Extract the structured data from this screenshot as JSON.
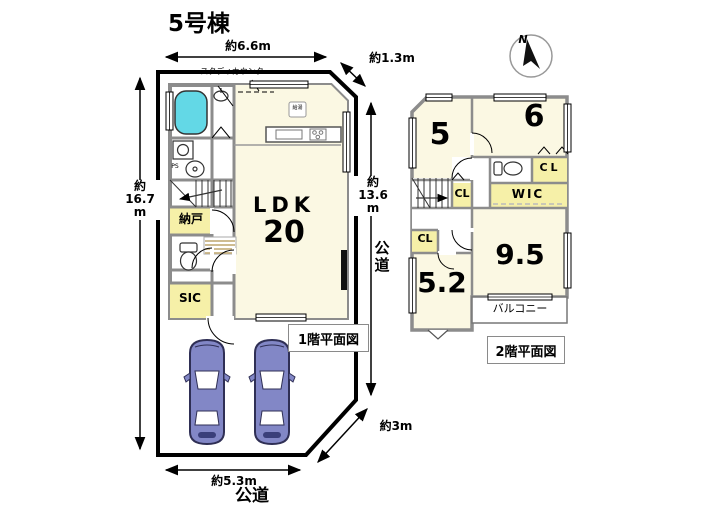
{
  "title": "5号棟",
  "compass": {
    "north": "N"
  },
  "floor1": {
    "plan_label": "1階平面図",
    "ldk_name": "LDK",
    "ldk_size": "20",
    "nando": "納戸",
    "sic": "SIC",
    "ps": "PS",
    "study_counter": "スタディカウンター",
    "water_heater": "給湯",
    "dim_top": "約6.6m",
    "dim_top_right": "約1.3m",
    "dim_left": "約\n16.7\nm",
    "dim_right": "約\n13.6\nm",
    "dim_bottom": "約5.3m",
    "dim_bottom_right": "約3m",
    "road_right": "公\n道",
    "road_bottom": "公道"
  },
  "floor2": {
    "plan_label": "2階平面図",
    "room5": "5",
    "room6": "6",
    "room52": "5.2",
    "room95": "9.5",
    "cl_a": "CL",
    "cl_b": "CL",
    "cl_c": "CL",
    "wic": "WIC",
    "balcony": "バルコニー"
  },
  "colors": {
    "room_fill": "#FBF8E3",
    "closet_fill": "#F6F0A8",
    "wall": "#8C8C8C",
    "site_boundary": "#000000",
    "bathtub": "#63D8E6",
    "car_body": "#8287C6",
    "car_outline": "#2F2F55",
    "entrance_hatch": "#C8B282"
  }
}
